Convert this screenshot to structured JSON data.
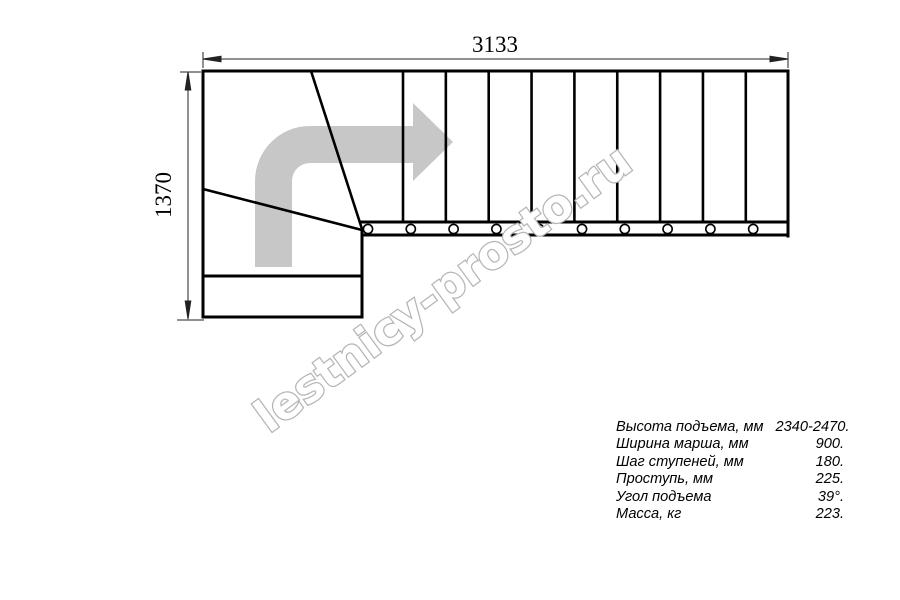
{
  "drawing": {
    "title": "stair-plan-top-view",
    "width_dim_label": "3133",
    "height_dim_label": "1370",
    "straight_tread_count": 10,
    "bolt_count": 10,
    "winder_tread_count": 2
  },
  "watermark": {
    "text": "lestnicy-prosto.ru"
  },
  "specs": {
    "rows": [
      {
        "label": "Высота подъема, мм",
        "value": "2340-2470."
      },
      {
        "label": "Ширина марша, мм",
        "value": "900."
      },
      {
        "label": "Шаг ступеней, мм",
        "value": "180."
      },
      {
        "label": "Проступь, мм",
        "value": "225."
      },
      {
        "label": "Угол подъема",
        "value": "39°."
      },
      {
        "label": "Масса, кг",
        "value": "223."
      }
    ]
  },
  "colors": {
    "line": "#000000",
    "dimension": "#222222",
    "arrow_fill": "#c7c7c7",
    "watermark_stroke": "#b5b5b5",
    "background": "#ffffff"
  }
}
